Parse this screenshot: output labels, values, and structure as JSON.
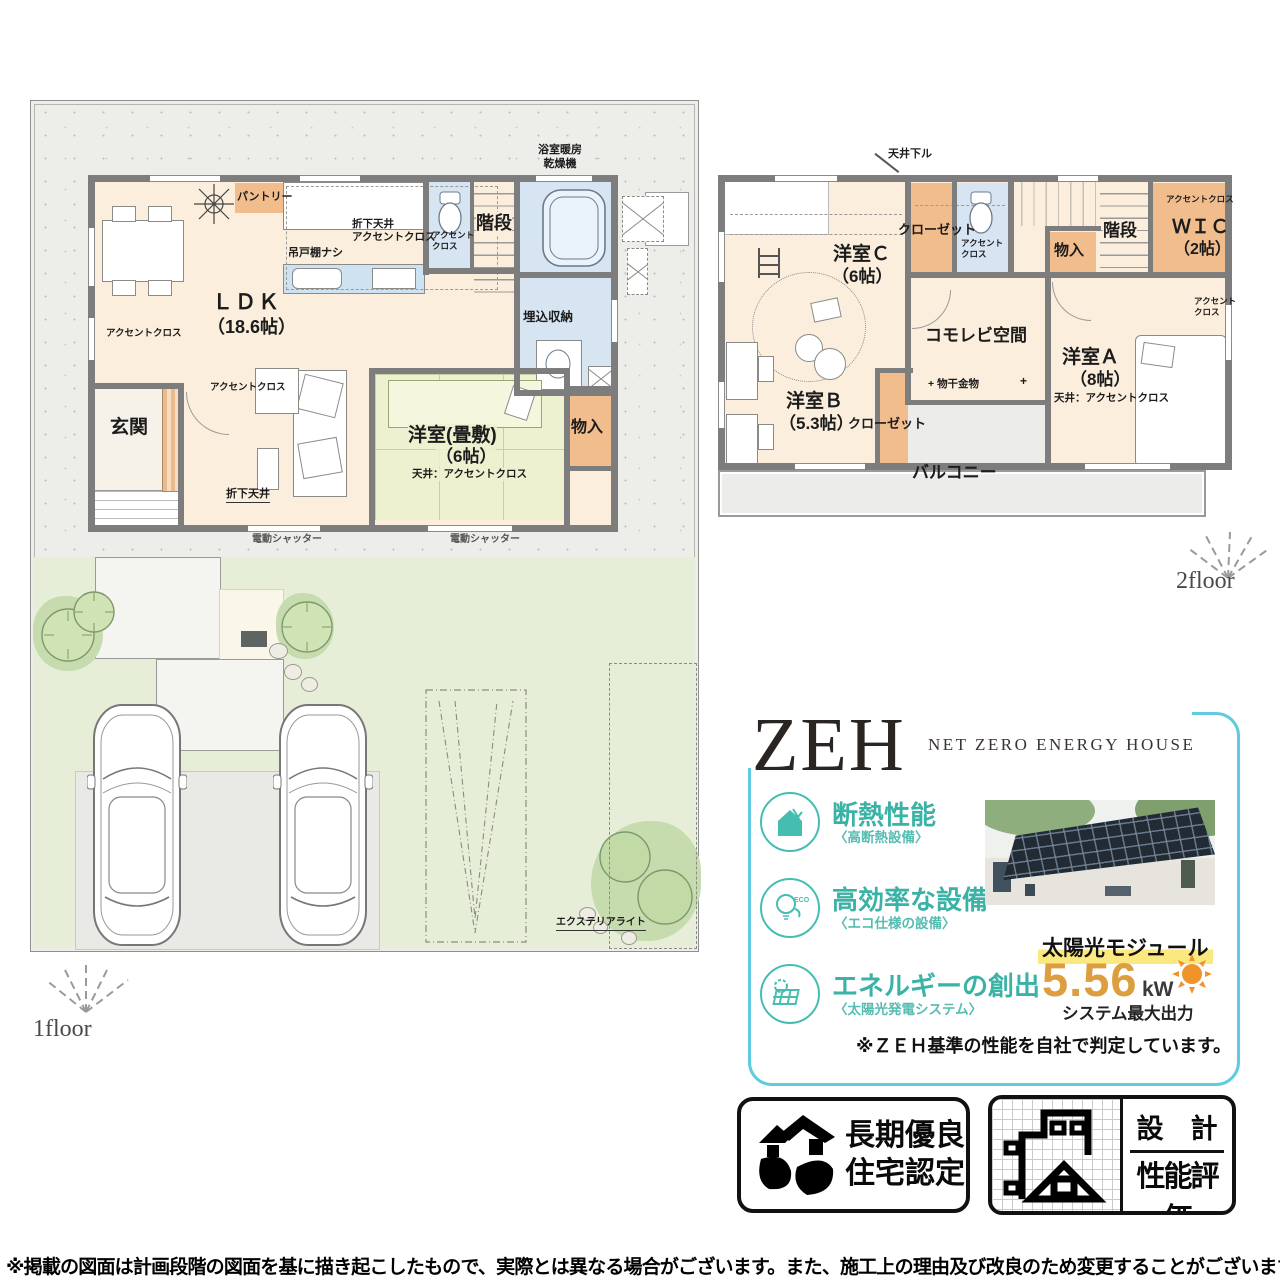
{
  "colors": {
    "zeh_border": "#5fcbdf",
    "teal": "#3bb2a6",
    "kw_orange": "#dc9e3e",
    "sun_orange": "#f0932a",
    "highlight_yellow": "#fbe97f",
    "wall_gray": "#7d7d7d",
    "tatami_green": "#edf1cf",
    "water_blue": "#d7e5f3",
    "closet_orange": "#f2bd8d"
  },
  "f1": {
    "floor_label": "1floor",
    "ldk": "ＬＤＫ",
    "ldk_size": "（18.6帖）",
    "pantry": "パントリー",
    "kitchen_note": "吊戸棚ナシ",
    "kitchen_ceiling": "折下天井\nアクセントクロス",
    "toilet_accent": "アクセント\nクロス",
    "stairs": "階段",
    "bath_heater": "浴室暖房\n乾燥機",
    "storage": "埋込収納",
    "wall_accent_left": "アクセントクロス",
    "genkan": "玄関",
    "wall_accent_living": "アクセントクロス",
    "down_ceiling": "折下天井",
    "tatami_name": "洋室(畳敷)",
    "tatami_size": "（6帖）",
    "tatami_ceiling": "天井：アクセントクロス",
    "monoire": "物入",
    "shutter": "電動シャッター",
    "exterior_light": "エクステリアライト"
  },
  "f2": {
    "floor_label": "2floor",
    "tenjo": "天井下ル",
    "room_c": "洋室Ｃ",
    "room_c_size": "（6帖）",
    "closet": "クローゼット",
    "toilet_accent": "アクセント\nクロス",
    "monoire": "物入",
    "stairs": "階段",
    "wic": "ＷＩＣ",
    "wic_size": "（2帖）",
    "wic_accent": "アクセントクロス",
    "komorebi": "コモレビ空間",
    "monohoshi": "物干金物",
    "plus_mark": "+",
    "room_a": "洋室Ａ",
    "room_a_size": "（8帖）",
    "room_a_ceiling": "天井：アクセントクロス",
    "accent_a": "アクセント\nクロス",
    "room_b": "洋室Ｂ",
    "room_b_size": "（5.3帖）",
    "balcony": "バルコニー"
  },
  "zeh": {
    "title": "ZEH",
    "subtitle": "NET ZERO ENERGY HOUSE",
    "features": [
      {
        "title": "断熱性能",
        "sub": "〈高断熱設備〉"
      },
      {
        "title": "高効率な設備",
        "sub": "〈エコ仕様の設備〉"
      },
      {
        "title": "エネルギーの創出",
        "sub": "〈太陽光発電システム〉"
      }
    ],
    "eco_text": "ECO",
    "module_label": "太陽光モジュール",
    "kw_value": "5.56",
    "kw_unit": "kW",
    "system_label": "システム最大出力",
    "note": "※ＺＥＨ基準の性能を自社で判定しています。"
  },
  "badges": {
    "b1_line1": "長期優良",
    "b1_line2": "住宅認定",
    "b2_top": "設　計",
    "b2_bottom": "性能評価"
  },
  "footer": {
    "disclaimer": "※掲載の図面は計画段階の図面を基に描き起こしたもので、実際とは異なる場合がございます。また、施工上の理由及び改良のため変更することがございます。"
  }
}
